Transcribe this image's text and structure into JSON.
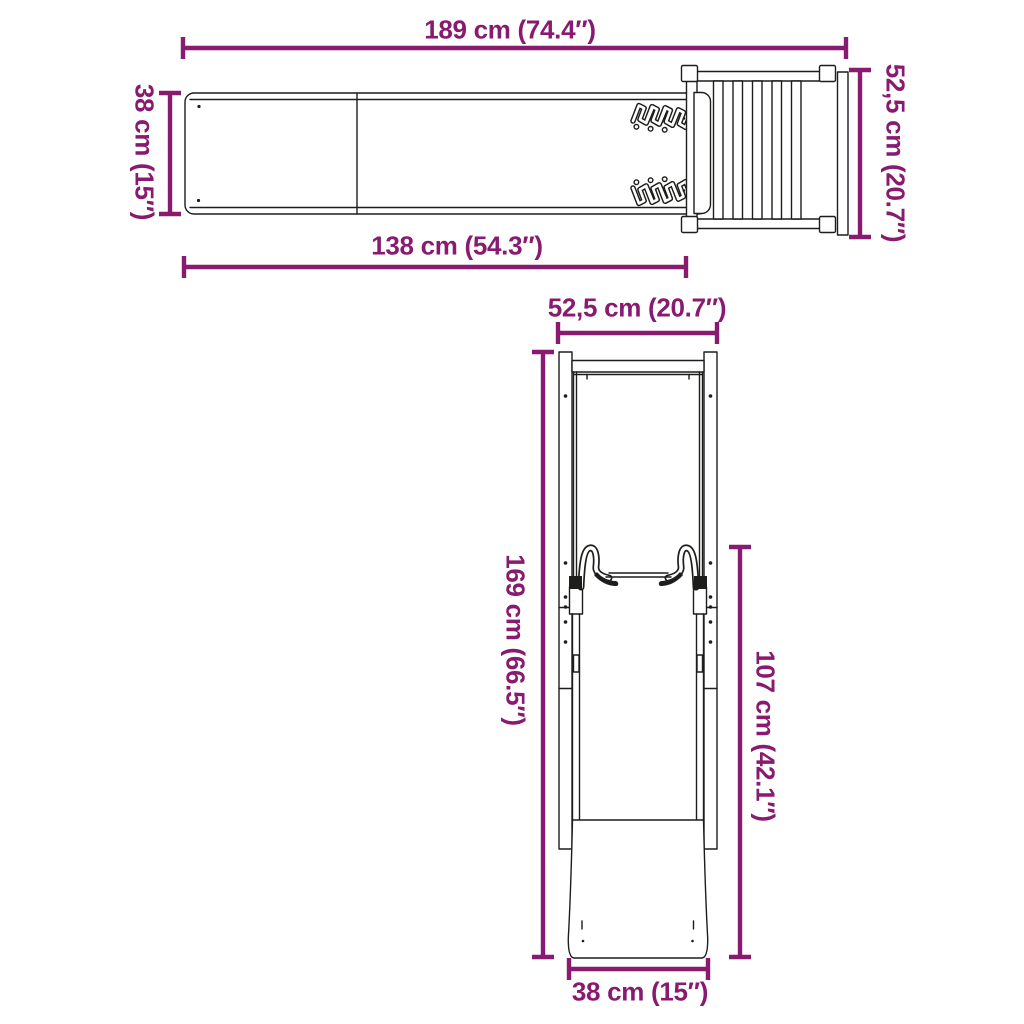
{
  "colors": {
    "accent": "#881a70",
    "line": "#1d1d1b",
    "background": "#ffffff"
  },
  "top_view": {
    "dim_total_length": "189 cm (74.4″)",
    "dim_slide_width": "38 cm (15″)",
    "dim_platform_depth": "52,5 cm (20.7″)",
    "dim_slide_length": "138 cm (54.3″)"
  },
  "front_view": {
    "dim_width": "52,5 cm (20.7″)",
    "dim_total_height": "169 cm (66.5″)",
    "dim_platform_height": "107 cm (42.1″)",
    "dim_base_width": "38 cm (15″)"
  }
}
